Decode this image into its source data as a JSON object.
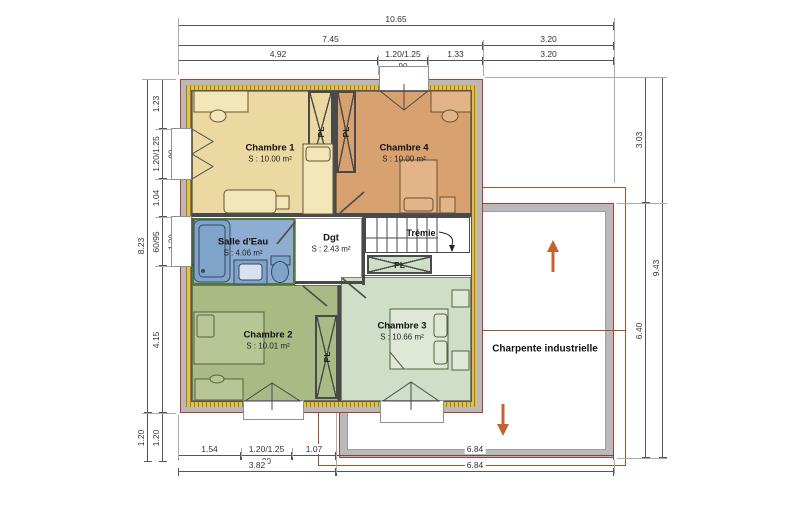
{
  "title": "Plan d'étage",
  "colors": {
    "wall_gray": "#b9b9bb",
    "wall_outline_red": "#b23b2a",
    "insulation_yellow": "#e3c04a",
    "roof_line_brown": "#9c5426",
    "arrow_orange": "#c2652f",
    "chambre1": "#ecd9a2",
    "chambre4": "#d7a26f",
    "salle_deau": "#8fadd2",
    "salle_deau_border": "#4e7a34",
    "chambre2": "#a8bb85",
    "chambre3": "#cfdfc7",
    "dgt": "#ffffff"
  },
  "rooms": [
    {
      "id": "chambre1",
      "name": "Chambre 1",
      "area": "S : 10.00 m²",
      "color": "#ecd9a2",
      "x": 192,
      "y": 91,
      "w": 141,
      "h": 124,
      "cx": 270,
      "cy": 153
    },
    {
      "id": "chambre4",
      "name": "Chambre 4",
      "area": "S : 10.00 m²",
      "color": "#d7a26f",
      "x": 336,
      "y": 91,
      "w": 135,
      "h": 124,
      "cx": 404,
      "cy": 153
    },
    {
      "id": "salle-deau",
      "name": "Salle d'Eau",
      "area": "S : 4.06 m²",
      "color": "#8fadd2",
      "x": 192,
      "y": 218,
      "w": 103,
      "h": 67,
      "cx": 243,
      "cy": 247,
      "border": "2px solid #4e7a34"
    },
    {
      "id": "dgt",
      "name": "Dgt",
      "area": "S : 2.43 m²",
      "color": "#ffffff",
      "x": 295,
      "y": 218,
      "w": 67,
      "h": 65,
      "cx": 331,
      "cy": 243
    },
    {
      "id": "chambre2",
      "name": "Chambre 2",
      "area": "S : 10.01 m²",
      "color": "#a8bb85",
      "x": 192,
      "y": 285,
      "w": 146,
      "h": 116,
      "cx": 268,
      "cy": 340
    },
    {
      "id": "chambre3",
      "name": "Chambre 3",
      "area": "S : 10.66 m²",
      "color": "#cfdfc7",
      "x": 341,
      "y": 277,
      "w": 130,
      "h": 124,
      "cx": 402,
      "cy": 331
    }
  ],
  "closets": [
    {
      "id": "pl-chambre1",
      "label": "PL",
      "x": 308,
      "y": 91,
      "w": 25,
      "h": 82,
      "bg": "#ecd9a2",
      "vertical": true
    },
    {
      "id": "pl-chambre4",
      "label": "PL",
      "x": 336,
      "y": 91,
      "w": 20,
      "h": 82,
      "bg": "#d7a26f",
      "vertical": true
    },
    {
      "id": "pl-hall",
      "label": "PL",
      "x": 367,
      "y": 255,
      "w": 65,
      "h": 19,
      "bg": "#cfdfc7",
      "vertical": false
    },
    {
      "id": "pl-chambre2",
      "label": "PL",
      "x": 315,
      "y": 315,
      "w": 23,
      "h": 84,
      "bg": "#a8bb85",
      "vertical": true
    }
  ],
  "annotations": {
    "tremie": {
      "text": "Trémie",
      "cx": 421,
      "cy": 233
    },
    "charpente": {
      "text": "Charpente industrielle",
      "cx": 545,
      "cy": 349
    }
  },
  "dimensions": {
    "h": [
      {
        "label": "10.65",
        "x": 178,
        "y": 25,
        "len": 436
      },
      {
        "label": "7.45",
        "x": 178,
        "y": 45,
        "len": 305
      },
      {
        "label": "3.20",
        "x": 483,
        "y": 45,
        "len": 131
      },
      {
        "label": "4.92",
        "x": 178,
        "y": 60,
        "len": 200
      },
      {
        "label": "1.20/1.25",
        "x": 378,
        "y": 60,
        "len": 50,
        "sub": "90"
      },
      {
        "label": "1.33",
        "x": 428,
        "y": 60,
        "len": 55
      },
      {
        "label": "3.20",
        "x": 483,
        "y": 60,
        "len": 131
      },
      {
        "label": "1.54",
        "x": 178,
        "y": 455,
        "len": 63
      },
      {
        "label": "1.20/1.25",
        "x": 241,
        "y": 455,
        "len": 51,
        "sub": "90"
      },
      {
        "label": "1.07",
        "x": 292,
        "y": 455,
        "len": 44
      },
      {
        "label": "6.84",
        "x": 336,
        "y": 455,
        "len": 278
      },
      {
        "label": "3.82",
        "x": 178,
        "y": 471,
        "len": 158
      },
      {
        "label": "6.84",
        "x": 336,
        "y": 471,
        "len": 278
      }
    ],
    "v": [
      {
        "label": "8.23",
        "x": 147,
        "y": 79,
        "len": 334
      },
      {
        "label": "1.20",
        "x": 147,
        "y": 413,
        "len": 49
      },
      {
        "label": "1.23",
        "x": 162,
        "y": 79,
        "len": 50
      },
      {
        "label": "1.20/1.25",
        "x": 162,
        "y": 129,
        "len": 50,
        "sub": "90"
      },
      {
        "label": "1.04",
        "x": 162,
        "y": 179,
        "len": 38
      },
      {
        "label": "60/95",
        "x": 162,
        "y": 217,
        "len": 49,
        "sub": "1.20"
      },
      {
        "label": "4.15",
        "x": 162,
        "y": 266,
        "len": 147
      },
      {
        "label": "1.20",
        "x": 162,
        "y": 413,
        "len": 49
      },
      {
        "label": "3.03",
        "x": 645,
        "y": 77,
        "len": 126
      },
      {
        "label": "6.40",
        "x": 645,
        "y": 203,
        "len": 255
      },
      {
        "label": "9.43",
        "x": 662,
        "y": 77,
        "len": 381
      }
    ],
    "ext": [
      {
        "x": 178,
        "y": 18,
        "w": 1,
        "h": 57
      },
      {
        "x": 614,
        "y": 18,
        "w": 1,
        "h": 165
      },
      {
        "x": 483,
        "y": 40,
        "w": 1,
        "h": 36
      },
      {
        "x": 378,
        "y": 55,
        "w": 1,
        "h": 20
      },
      {
        "x": 428,
        "y": 55,
        "w": 1,
        "h": 20
      },
      {
        "x": 142,
        "y": 79,
        "w": 34,
        "h": 1
      },
      {
        "x": 142,
        "y": 413,
        "w": 34,
        "h": 1
      },
      {
        "x": 155,
        "y": 129,
        "w": 22,
        "h": 1
      },
      {
        "x": 155,
        "y": 179,
        "w": 22,
        "h": 1
      },
      {
        "x": 155,
        "y": 217,
        "w": 22,
        "h": 1
      },
      {
        "x": 155,
        "y": 266,
        "w": 22,
        "h": 1
      },
      {
        "x": 485,
        "y": 77,
        "w": 182,
        "h": 1
      },
      {
        "x": 617,
        "y": 203,
        "w": 50,
        "h": 1
      },
      {
        "x": 617,
        "y": 458,
        "w": 50,
        "h": 1
      },
      {
        "x": 178,
        "y": 415,
        "w": 1,
        "h": 44
      },
      {
        "x": 241,
        "y": 448,
        "w": 1,
        "h": 9
      },
      {
        "x": 292,
        "y": 448,
        "w": 1,
        "h": 9
      },
      {
        "x": 336,
        "y": 413,
        "w": 1,
        "h": 60
      },
      {
        "x": 614,
        "y": 460,
        "w": 1,
        "h": 14
      }
    ]
  }
}
